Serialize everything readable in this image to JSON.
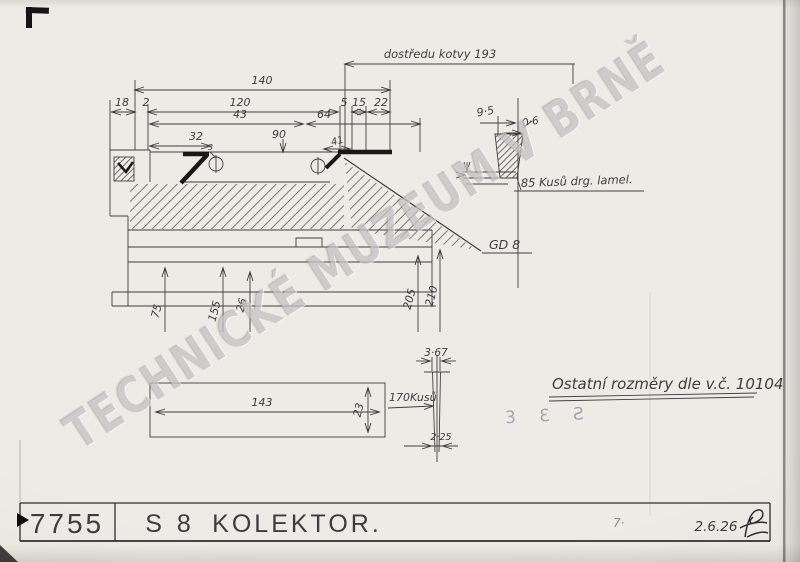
{
  "sheet": {
    "watermark": "TECHNICKÉ MUZEUM V BRNĚ",
    "stamp_mark": "3 Ɛ Ƨ",
    "page_mark": "7·"
  },
  "notes": {
    "armature": "dostředu kotvy 193",
    "gd": "GD 8",
    "lamellas_85": "85 Kusů drg. lamel.",
    "other_dims": "Ostatní rozměry dle v.č. 10104",
    "pieces_170": "170Kusů"
  },
  "dims": {
    "overall": "140",
    "a18": "18",
    "a2": "2",
    "a120": "120",
    "a5": "5",
    "a15": "15",
    "a22": "22",
    "b43": "43",
    "b64": "64",
    "c32": "32",
    "c90": "90",
    "c41": "41",
    "c3": "3",
    "dia75": "75",
    "dia155": "155",
    "dia26": "26",
    "dia205": "205",
    "dia210": "210",
    "det95": "9·5",
    "det06": "0·6",
    "bar143": "143",
    "bar23": "23",
    "lam367": "3·67",
    "lam225": "2·25"
  },
  "title_block": {
    "number": "7755",
    "series": "S 8",
    "title": "KOLEKTOR.",
    "date": "2.6.26"
  }
}
